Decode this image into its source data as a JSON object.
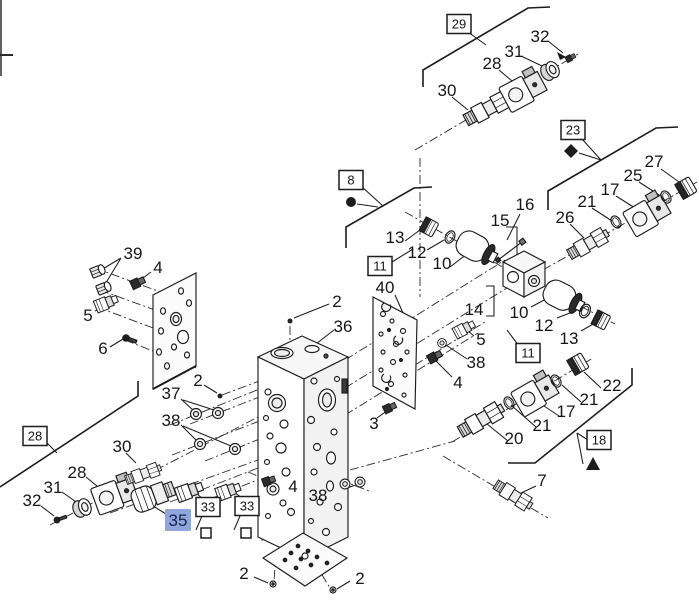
{
  "diagram": {
    "type": "exploded-parts-diagram",
    "background": "#ffffff",
    "line_color": "#1c1c1c",
    "highlight": {
      "bg": "#8fa6dc",
      "text": "#14204a"
    },
    "selected_callout": "35",
    "callouts": [
      {
        "label": "29",
        "x": 459,
        "y": 24,
        "style": "boxed"
      },
      {
        "label": "32",
        "x": 540,
        "y": 36,
        "style": "plain"
      },
      {
        "label": "31",
        "x": 514,
        "y": 51,
        "style": "plain"
      },
      {
        "label": "28",
        "x": 492,
        "y": 63,
        "style": "plain"
      },
      {
        "label": "30",
        "x": 447,
        "y": 90,
        "style": "plain"
      },
      {
        "label": "23",
        "x": 573,
        "y": 130,
        "style": "boxed"
      },
      {
        "label": "27",
        "x": 654,
        "y": 161,
        "style": "plain"
      },
      {
        "label": "25",
        "x": 633,
        "y": 175,
        "style": "plain"
      },
      {
        "label": "17",
        "x": 610,
        "y": 189,
        "style": "plain"
      },
      {
        "label": "21",
        "x": 587,
        "y": 201,
        "style": "plain"
      },
      {
        "label": "26",
        "x": 565,
        "y": 217,
        "style": "plain"
      },
      {
        "label": "16",
        "x": 525,
        "y": 204,
        "style": "plain"
      },
      {
        "label": "15",
        "x": 500,
        "y": 220,
        "style": "plain"
      },
      {
        "label": "8",
        "x": 351,
        "y": 180,
        "style": "boxed"
      },
      {
        "label": "13",
        "x": 395,
        "y": 237,
        "style": "plain"
      },
      {
        "label": "12",
        "x": 417,
        "y": 252,
        "style": "plain"
      },
      {
        "label": "10",
        "x": 442,
        "y": 263,
        "style": "plain"
      },
      {
        "label": "11",
        "x": 380,
        "y": 266,
        "style": "boxed"
      },
      {
        "label": "40",
        "x": 385,
        "y": 287,
        "style": "plain"
      },
      {
        "label": "14",
        "x": 474,
        "y": 309,
        "style": "plain"
      },
      {
        "label": "10",
        "x": 519,
        "y": 312,
        "style": "plain"
      },
      {
        "label": "12",
        "x": 544,
        "y": 325,
        "style": "plain"
      },
      {
        "label": "13",
        "x": 569,
        "y": 338,
        "style": "plain"
      },
      {
        "label": "11",
        "x": 528,
        "y": 353,
        "style": "boxed"
      },
      {
        "label": "22",
        "x": 612,
        "y": 385,
        "style": "plain"
      },
      {
        "label": "21",
        "x": 589,
        "y": 399,
        "style": "plain"
      },
      {
        "label": "17",
        "x": 566,
        "y": 411,
        "style": "plain"
      },
      {
        "label": "21",
        "x": 542,
        "y": 425,
        "style": "plain"
      },
      {
        "label": "20",
        "x": 514,
        "y": 438,
        "style": "plain"
      },
      {
        "label": "18",
        "x": 599,
        "y": 440,
        "style": "boxed"
      },
      {
        "label": "7",
        "x": 542,
        "y": 480,
        "style": "plain"
      },
      {
        "label": "2",
        "x": 337,
        "y": 301,
        "style": "plain"
      },
      {
        "label": "36",
        "x": 343,
        "y": 326,
        "style": "plain"
      },
      {
        "label": "3",
        "x": 374,
        "y": 423,
        "style": "plain"
      },
      {
        "label": "5",
        "x": 481,
        "y": 339,
        "style": "plain"
      },
      {
        "label": "38",
        "x": 476,
        "y": 362,
        "style": "plain"
      },
      {
        "label": "4",
        "x": 458,
        "y": 382,
        "style": "plain"
      },
      {
        "label": "39",
        "x": 133,
        "y": 253,
        "style": "plain"
      },
      {
        "label": "4",
        "x": 158,
        "y": 267,
        "style": "plain"
      },
      {
        "label": "5",
        "x": 88,
        "y": 315,
        "style": "plain"
      },
      {
        "label": "6",
        "x": 103,
        "y": 348,
        "style": "plain"
      },
      {
        "label": "2",
        "x": 198,
        "y": 380,
        "style": "plain"
      },
      {
        "label": "37",
        "x": 171,
        "y": 393,
        "style": "plain"
      },
      {
        "label": "38",
        "x": 171,
        "y": 420,
        "style": "plain"
      },
      {
        "label": "28",
        "x": 35,
        "y": 436,
        "style": "boxed"
      },
      {
        "label": "30",
        "x": 122,
        "y": 446,
        "style": "plain"
      },
      {
        "label": "28",
        "x": 77,
        "y": 472,
        "style": "plain"
      },
      {
        "label": "31",
        "x": 53,
        "y": 487,
        "style": "plain"
      },
      {
        "label": "32",
        "x": 32,
        "y": 500,
        "style": "plain"
      },
      {
        "label": "35",
        "x": 178,
        "y": 520,
        "style": "highlighted"
      },
      {
        "label": "33",
        "x": 208,
        "y": 507,
        "style": "boxed"
      },
      {
        "label": "33",
        "x": 247,
        "y": 506,
        "style": "boxed"
      },
      {
        "label": "4",
        "x": 293,
        "y": 486,
        "style": "plain"
      },
      {
        "label": "38",
        "x": 318,
        "y": 495,
        "style": "plain"
      },
      {
        "label": "2",
        "x": 244,
        "y": 573,
        "style": "plain"
      },
      {
        "label": "2",
        "x": 360,
        "y": 578,
        "style": "plain"
      }
    ],
    "symbols": [
      {
        "name": "filled-circle-symbol",
        "x": 351,
        "y": 202
      },
      {
        "name": "filled-diamond-symbol",
        "x": 571,
        "y": 151
      },
      {
        "name": "filled-triangle-symbol",
        "x": 593,
        "y": 464
      },
      {
        "name": "open-square-symbol",
        "x": 206,
        "y": 533
      },
      {
        "name": "open-square-symbol",
        "x": 246,
        "y": 533
      }
    ]
  }
}
